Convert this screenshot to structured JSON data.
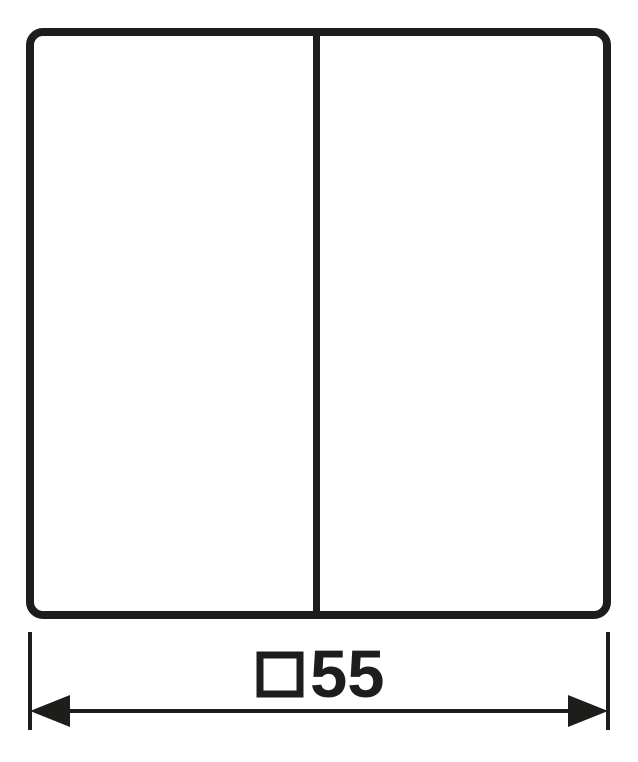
{
  "drawing": {
    "background_color": "#ffffff",
    "line_color": "#1d1d1b"
  },
  "dimension_label": {
    "square_symbol": "□",
    "value": "55",
    "full_label": "□55"
  }
}
